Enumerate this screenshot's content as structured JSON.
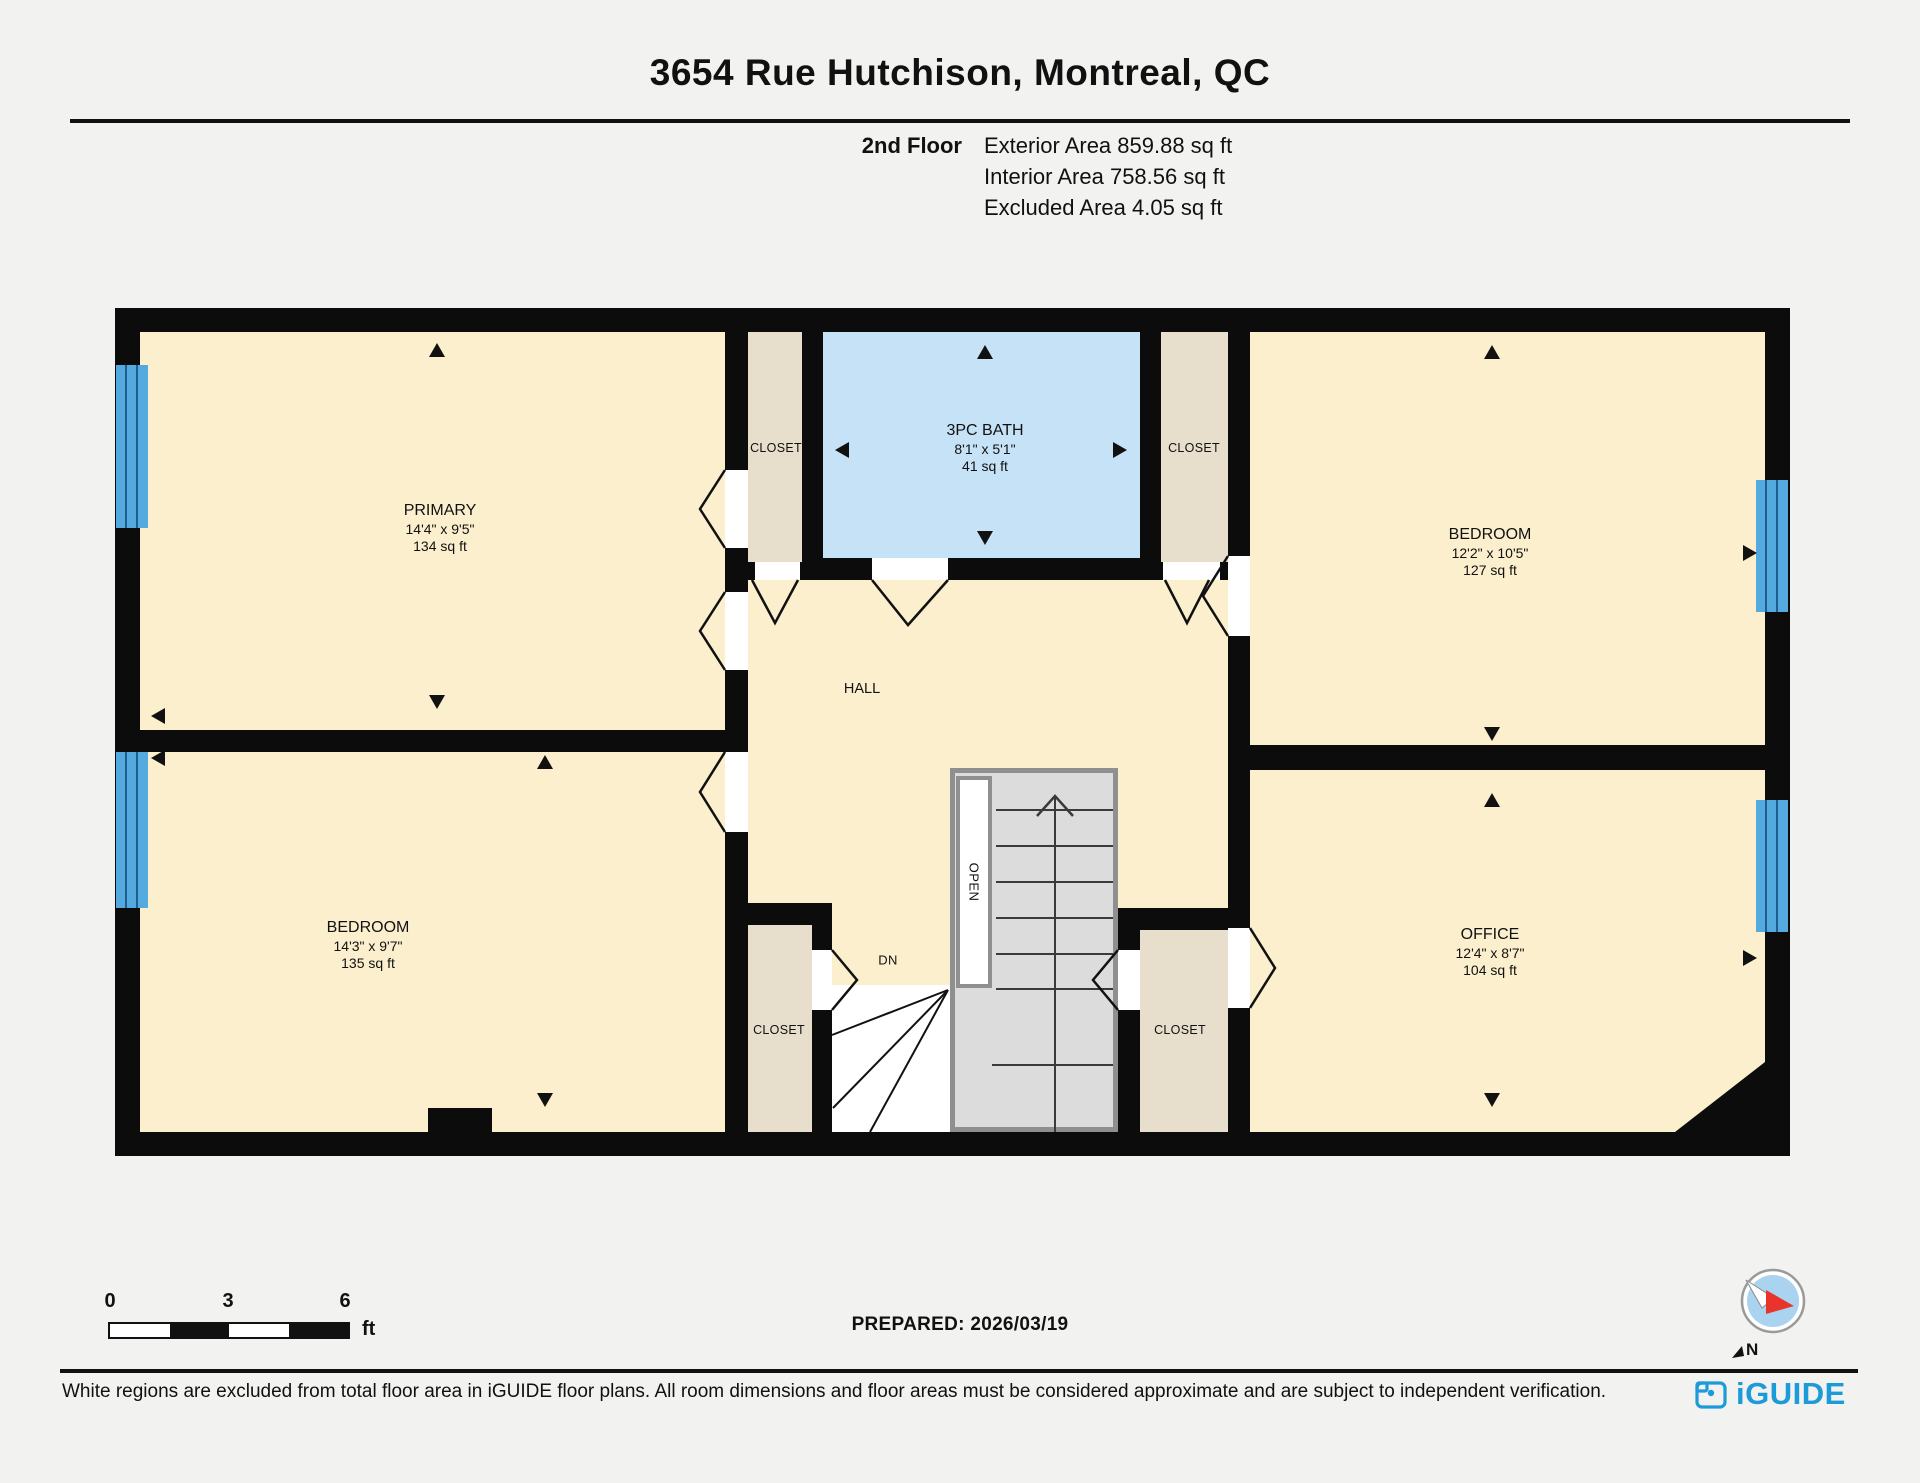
{
  "header": {
    "title": "3654 Rue Hutchison, Montreal, QC",
    "floor_label": "2nd Floor",
    "exterior_area": "Exterior Area 859.88 sq ft",
    "interior_area": "Interior Area 758.56 sq ft",
    "excluded_area": "Excluded Area 4.05 sq ft"
  },
  "rooms": {
    "primary": {
      "name": "PRIMARY",
      "dims": "14'4\" x 9'5\"",
      "area": "134 sq ft"
    },
    "bath": {
      "name": "3PC BATH",
      "dims": "8'1\" x 5'1\"",
      "area": "41 sq ft"
    },
    "bedroom_tr": {
      "name": "BEDROOM",
      "dims": "12'2\" x 10'5\"",
      "area": "127 sq ft"
    },
    "bedroom_bl": {
      "name": "BEDROOM",
      "dims": "14'3\" x 9'7\"",
      "area": "135 sq ft"
    },
    "office": {
      "name": "OFFICE",
      "dims": "12'4\" x 8'7\"",
      "area": "104 sq ft"
    },
    "hall": {
      "name": "HALL"
    },
    "closet_top_left": {
      "name": "CLOSET"
    },
    "closet_top_right": {
      "name": "CLOSET"
    },
    "closet_bottom_left": {
      "name": "CLOSET"
    },
    "closet_bottom_right": {
      "name": "CLOSET"
    },
    "stairs": {
      "open_label": "OPEN",
      "down_label": "DN"
    }
  },
  "scale_bar": {
    "tick0": "0",
    "tick3": "3",
    "tick6": "6",
    "unit": "ft"
  },
  "footer": {
    "prepared": "PREPARED: 2026/03/19",
    "disclaimer": "White regions are excluded from total floor area in iGUIDE floor plans. All room dimensions and floor areas must be considered approximate and are subject to independent verification.",
    "logo_text": "iGUIDE",
    "compass_label": "N"
  },
  "colors": {
    "room_fill": "#fbefcd",
    "closet_fill": "#e8decc",
    "bath_fill": "#c5e2f7",
    "window_blue": "#54a9de",
    "wall": "#0c0c0c",
    "stair_fill": "#dcdcdc",
    "logo_blue": "#1c9bd8",
    "compass_red": "#e8342a"
  }
}
